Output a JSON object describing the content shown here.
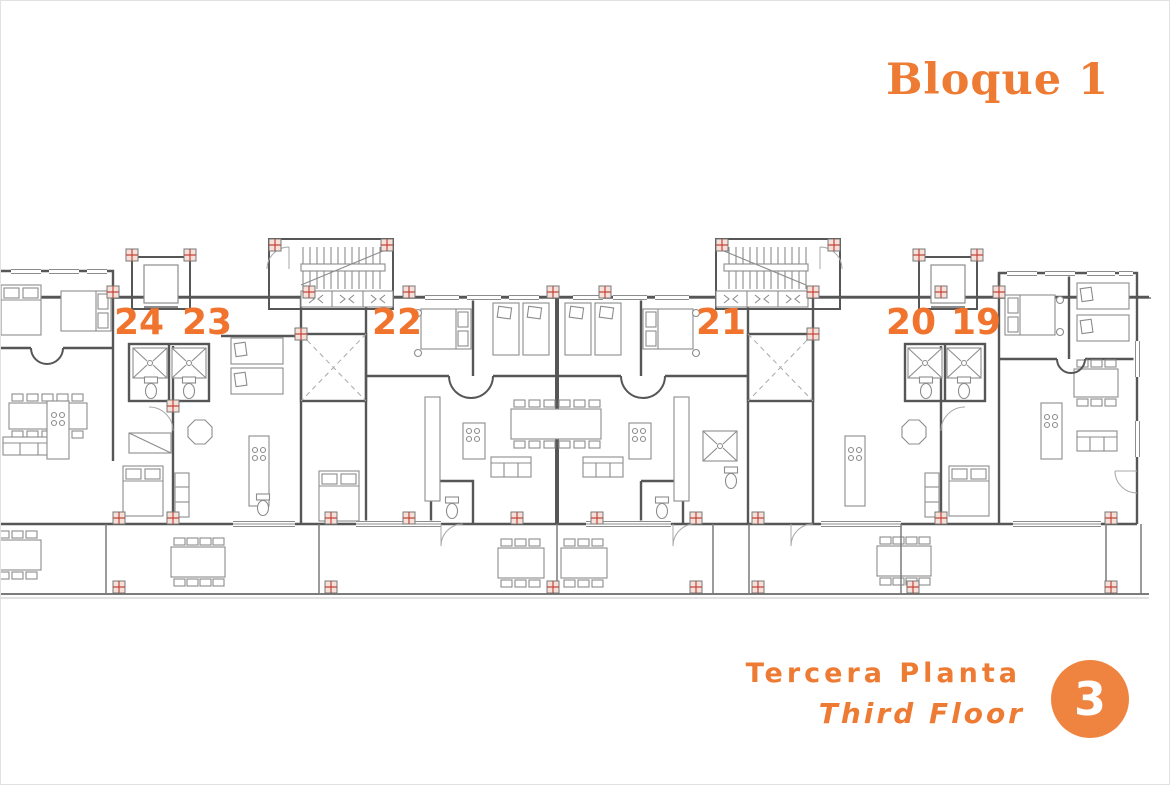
{
  "header": {
    "block_title": "Bloque 1"
  },
  "plan": {
    "units": [
      {
        "label": "24"
      },
      {
        "label": "23"
      },
      {
        "label": "22"
      },
      {
        "label": "21"
      },
      {
        "label": "20"
      },
      {
        "label": "19"
      }
    ]
  },
  "footer": {
    "floor_title_es": "Tercera Planta",
    "floor_title_en": "Third Floor",
    "floor_number": "3"
  },
  "colors": {
    "accent_orange": "#EE7B33",
    "badge_orange": "#EF8440",
    "wall_gray": "#565656",
    "furniture_gray": "#8c8c8c",
    "column_marker_red": "#c4453a"
  }
}
